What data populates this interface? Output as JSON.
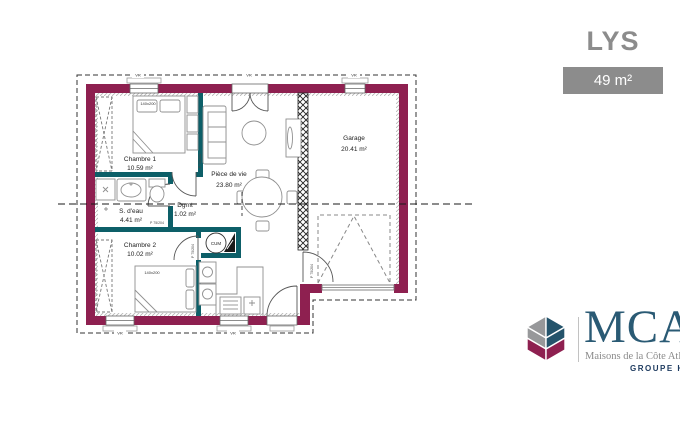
{
  "header": {
    "title": "LYS",
    "area_badge": "49 m²"
  },
  "colors": {
    "exterior_wall": "#8e2050",
    "interior_wall": "#0d5f68",
    "gray_accent": "#8c8c8c",
    "logo_navy": "#24536b",
    "logo_maroon": "#8e2050",
    "logo_gray": "#97989a",
    "logo_text": "#2a5a74"
  },
  "rooms": {
    "chambre1": {
      "name": "Chambre 1",
      "area": "10.59 m²"
    },
    "sdeau": {
      "name": "S. d'eau",
      "area": "4.41 m²"
    },
    "chambre2": {
      "name": "Chambre 2",
      "area": "10.02 m²"
    },
    "degagement": {
      "name": "Dgmt",
      "area": "1.02 m²"
    },
    "piece_de_vie": {
      "name": "Pièce de vie",
      "area": "23.80 m²"
    },
    "garage": {
      "name": "Garage",
      "area": "20.41 m²"
    }
  },
  "labels": {
    "bed": "140x200",
    "water_heater": "CUM",
    "door": "P 75/204",
    "window": "VR"
  },
  "logo": {
    "acronym": "MCA",
    "subtitle": "Maisons de la Côte Atlanti",
    "group": "GROUPE Hexa"
  }
}
